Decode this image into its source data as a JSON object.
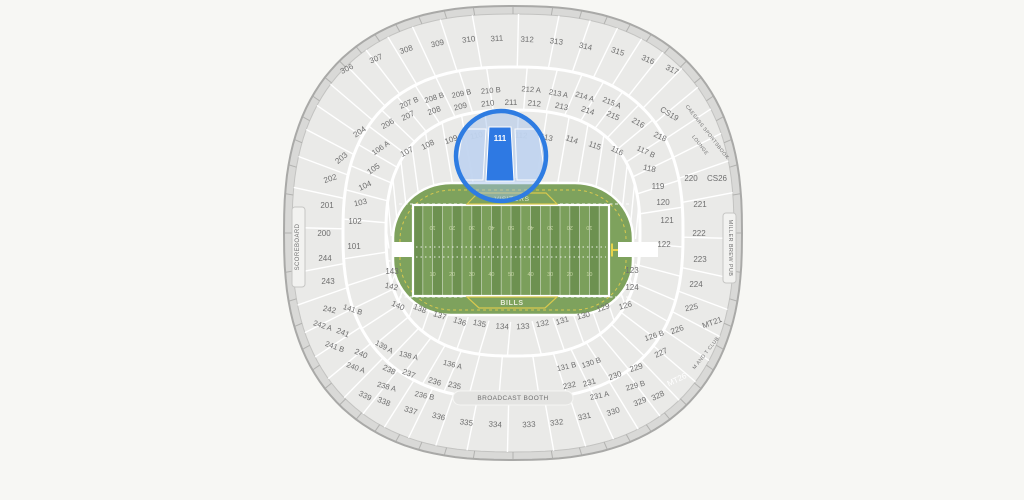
{
  "map": {
    "colors": {
      "page_bg": "#f7f7f4",
      "bowl": "#eaeae8",
      "wall_band": "#d9d9d7",
      "wall_stroke": "#a9a9a7",
      "bowl_stroke": "#c3c3c1",
      "seam": "#ffffff",
      "label": "#6f6f6f",
      "field_base": "#7ea25d",
      "stripe_dark": "#6d9150",
      "stripe_light": "#7b9f5b",
      "yard_number": "#c6d6a4",
      "boundary_yellow": "#d9c94e",
      "goalpost_yellow": "#e6d24b",
      "team_text": "#e9ecdb",
      "accent_blue": "#2e79e3",
      "magnifier_ring": "#2e7ce2",
      "magnifier_tint": "rgba(160,190,235,0.45)",
      "magnifier_section_light": "#c2d5f0",
      "light_label": "#ffffff",
      "strip_fill": "#f2f2f0",
      "strip_stroke": "#c6c6c4",
      "booth_fill": "#e4e4e2"
    },
    "field": {
      "visitors_label": "VISITORS",
      "home_label": "BILLS",
      "yard_numbers": [
        "10",
        "20",
        "30",
        "40",
        "50",
        "40",
        "30",
        "20",
        "10"
      ]
    },
    "magnifier": {
      "section": "111",
      "cx": 501,
      "cy": 156,
      "radius": 45
    },
    "sections": [
      {
        "l": "306",
        "x": 348,
        "y": 71
      },
      {
        "l": "307",
        "x": 377,
        "y": 61
      },
      {
        "l": "308",
        "x": 407,
        "y": 52
      },
      {
        "l": "309",
        "x": 438,
        "y": 46
      },
      {
        "l": "310",
        "x": 469,
        "y": 42
      },
      {
        "l": "311",
        "x": 497,
        "y": 41
      },
      {
        "l": "312",
        "x": 527,
        "y": 42
      },
      {
        "l": "313",
        "x": 556,
        "y": 44
      },
      {
        "l": "314",
        "x": 585,
        "y": 49
      },
      {
        "l": "315",
        "x": 617,
        "y": 54
      },
      {
        "l": "316",
        "x": 647,
        "y": 62
      },
      {
        "l": "317",
        "x": 671,
        "y": 72
      },
      {
        "l": "207 B",
        "x": 410,
        "y": 105
      },
      {
        "l": "208 B",
        "x": 435,
        "y": 100
      },
      {
        "l": "209 B",
        "x": 462,
        "y": 96
      },
      {
        "l": "210 B",
        "x": 491,
        "y": 93
      },
      {
        "l": "212 A",
        "x": 531,
        "y": 92
      },
      {
        "l": "213 A",
        "x": 558,
        "y": 96
      },
      {
        "l": "214 A",
        "x": 584,
        "y": 99
      },
      {
        "l": "215 A",
        "x": 611,
        "y": 105
      },
      {
        "l": "206",
        "x": 389,
        "y": 126
      },
      {
        "l": "207",
        "x": 409,
        "y": 118
      },
      {
        "l": "208",
        "x": 435,
        "y": 113
      },
      {
        "l": "209",
        "x": 461,
        "y": 109
      },
      {
        "l": "210",
        "x": 488,
        "y": 106
      },
      {
        "l": "211",
        "x": 511,
        "y": 105
      },
      {
        "l": "212",
        "x": 534,
        "y": 106
      },
      {
        "l": "213",
        "x": 561,
        "y": 109
      },
      {
        "l": "214",
        "x": 587,
        "y": 113
      },
      {
        "l": "215",
        "x": 612,
        "y": 118
      },
      {
        "l": "216",
        "x": 637,
        "y": 125
      },
      {
        "l": "218",
        "x": 659,
        "y": 139,
        "r": 25
      },
      {
        "l": "CS19",
        "x": 668,
        "y": 116
      },
      {
        "l": "106 A",
        "x": 382,
        "y": 150
      },
      {
        "l": "107",
        "x": 408,
        "y": 154,
        "r": -28
      },
      {
        "l": "108",
        "x": 429,
        "y": 147
      },
      {
        "l": "109",
        "x": 452,
        "y": 142
      },
      {
        "l": "110",
        "x": 477,
        "y": 138
      },
      {
        "l": "112",
        "x": 521,
        "y": 138
      },
      {
        "l": "113",
        "x": 546,
        "y": 140
      },
      {
        "l": "114",
        "x": 571,
        "y": 142
      },
      {
        "l": "115",
        "x": 594,
        "y": 148,
        "r": 20
      },
      {
        "l": "116",
        "x": 616,
        "y": 153,
        "r": 26
      },
      {
        "l": "117 B",
        "x": 645,
        "y": 154,
        "r": 25
      },
      {
        "l": "118",
        "x": 649,
        "y": 171,
        "r": 12
      },
      {
        "l": "119",
        "x": 658,
        "y": 189
      },
      {
        "l": "120",
        "x": 663,
        "y": 205
      },
      {
        "l": "220",
        "x": 691,
        "y": 181
      },
      {
        "l": "CS26",
        "x": 717,
        "y": 181
      },
      {
        "l": "221",
        "x": 700,
        "y": 207
      },
      {
        "l": "222",
        "x": 699,
        "y": 236
      },
      {
        "l": "223",
        "x": 700,
        "y": 262
      },
      {
        "l": "224",
        "x": 696,
        "y": 287
      },
      {
        "l": "225",
        "x": 692,
        "y": 310,
        "r": -12
      },
      {
        "l": "226",
        "x": 678,
        "y": 332,
        "r": -20
      },
      {
        "l": "227",
        "x": 662,
        "y": 355,
        "r": -25
      },
      {
        "l": "MT21",
        "x": 713,
        "y": 325,
        "r": -20
      },
      {
        "l": "121",
        "x": 667,
        "y": 223
      },
      {
        "l": "122",
        "x": 664,
        "y": 247
      },
      {
        "l": "123",
        "x": 632,
        "y": 273
      },
      {
        "l": "124",
        "x": 632,
        "y": 290
      },
      {
        "l": "126",
        "x": 626,
        "y": 308,
        "r": -15
      },
      {
        "l": "126 B",
        "x": 655,
        "y": 338,
        "r": -18
      },
      {
        "l": "204",
        "x": 361,
        "y": 134
      },
      {
        "l": "203",
        "x": 343,
        "y": 160,
        "r": -40
      },
      {
        "l": "202",
        "x": 331,
        "y": 181,
        "r": -18
      },
      {
        "l": "201",
        "x": 327,
        "y": 208
      },
      {
        "l": "200",
        "x": 324,
        "y": 236
      },
      {
        "l": "244",
        "x": 325,
        "y": 261
      },
      {
        "l": "243",
        "x": 328,
        "y": 284
      },
      {
        "l": "242",
        "x": 329,
        "y": 312,
        "r": 12
      },
      {
        "l": "242 A",
        "x": 322,
        "y": 328,
        "r": 18
      },
      {
        "l": "241",
        "x": 342,
        "y": 335,
        "r": 22
      },
      {
        "l": "241 B",
        "x": 334,
        "y": 349,
        "r": 20
      },
      {
        "l": "240",
        "x": 360,
        "y": 356,
        "r": 24
      },
      {
        "l": "240 A",
        "x": 355,
        "y": 370,
        "r": 20
      },
      {
        "l": "105",
        "x": 375,
        "y": 171,
        "r": -35
      },
      {
        "l": "104",
        "x": 366,
        "y": 188,
        "r": -25
      },
      {
        "l": "103",
        "x": 361,
        "y": 205,
        "r": -12
      },
      {
        "l": "102",
        "x": 355,
        "y": 224
      },
      {
        "l": "101",
        "x": 354,
        "y": 249
      },
      {
        "l": "143",
        "x": 392,
        "y": 274
      },
      {
        "l": "142",
        "x": 391,
        "y": 289,
        "r": 12
      },
      {
        "l": "141 B",
        "x": 352,
        "y": 312,
        "r": 18
      },
      {
        "l": "140",
        "x": 397,
        "y": 308,
        "r": 24
      },
      {
        "l": "139 A",
        "x": 383,
        "y": 349
      },
      {
        "l": "138 A",
        "x": 408,
        "y": 358,
        "r": 14
      },
      {
        "l": "138",
        "x": 419,
        "y": 311,
        "r": 22
      },
      {
        "l": "137",
        "x": 439,
        "y": 318,
        "r": 18
      },
      {
        "l": "136",
        "x": 459,
        "y": 324
      },
      {
        "l": "135",
        "x": 479,
        "y": 326
      },
      {
        "l": "134",
        "x": 502,
        "y": 329
      },
      {
        "l": "133",
        "x": 523,
        "y": 329
      },
      {
        "l": "132",
        "x": 543,
        "y": 326
      },
      {
        "l": "131",
        "x": 563,
        "y": 323
      },
      {
        "l": "130",
        "x": 584,
        "y": 318,
        "r": -14
      },
      {
        "l": "129",
        "x": 604,
        "y": 310,
        "r": -20
      },
      {
        "l": "136 A",
        "x": 452,
        "y": 367
      },
      {
        "l": "131 B",
        "x": 567,
        "y": 369
      },
      {
        "l": "130 B",
        "x": 592,
        "y": 365
      },
      {
        "l": "238",
        "x": 388,
        "y": 372
      },
      {
        "l": "237",
        "x": 408,
        "y": 376
      },
      {
        "l": "236",
        "x": 434,
        "y": 384
      },
      {
        "l": "235",
        "x": 454,
        "y": 388
      },
      {
        "l": "238 A",
        "x": 386,
        "y": 389,
        "r": 16
      },
      {
        "l": "236 B",
        "x": 424,
        "y": 398,
        "r": 12
      },
      {
        "l": "232",
        "x": 570,
        "y": 388
      },
      {
        "l": "231",
        "x": 590,
        "y": 385
      },
      {
        "l": "231 A",
        "x": 600,
        "y": 398,
        "r": -12
      },
      {
        "l": "230",
        "x": 616,
        "y": 378
      },
      {
        "l": "229",
        "x": 637,
        "y": 370,
        "r": -18
      },
      {
        "l": "229 B",
        "x": 636,
        "y": 388,
        "r": -16
      },
      {
        "l": "339",
        "x": 364,
        "y": 398,
        "r": 26
      },
      {
        "l": "338",
        "x": 383,
        "y": 404,
        "r": 22
      },
      {
        "l": "337",
        "x": 410,
        "y": 413,
        "r": 18
      },
      {
        "l": "336",
        "x": 438,
        "y": 419,
        "r": 14
      },
      {
        "l": "335",
        "x": 466,
        "y": 425,
        "r": 8
      },
      {
        "l": "334",
        "x": 495,
        "y": 427,
        "r": 4
      },
      {
        "l": "333",
        "x": 529,
        "y": 427,
        "r": -3
      },
      {
        "l": "332",
        "x": 557,
        "y": 425,
        "r": -8
      },
      {
        "l": "331",
        "x": 585,
        "y": 419,
        "r": -13
      },
      {
        "l": "330",
        "x": 614,
        "y": 414,
        "r": -18
      },
      {
        "l": "329",
        "x": 641,
        "y": 404,
        "r": -22
      },
      {
        "l": "328",
        "x": 659,
        "y": 398,
        "r": -26
      },
      {
        "l": "MT26",
        "x": 678,
        "y": 382,
        "r": -26,
        "light": true
      }
    ],
    "venue_labels": [
      {
        "l": "SCOREBOARD",
        "x": 299,
        "y": 247,
        "r": -90,
        "s": 6
      },
      {
        "l": "MILLER BREW PUB",
        "x": 729,
        "y": 248,
        "r": 90,
        "s": 5.5
      },
      {
        "l": "BROADCAST BOOTH",
        "x": 513,
        "y": 400,
        "r": 0,
        "s": 6.5
      },
      {
        "l": "CAESARS SPORTSBOOK",
        "x": 706,
        "y": 133,
        "r": 52,
        "s": 5
      },
      {
        "l": "LOUNGE",
        "x": 699,
        "y": 146,
        "r": 52,
        "s": 5
      },
      {
        "l": "M AND T CLUB",
        "x": 707,
        "y": 354,
        "r": -52,
        "s": 5
      }
    ]
  }
}
